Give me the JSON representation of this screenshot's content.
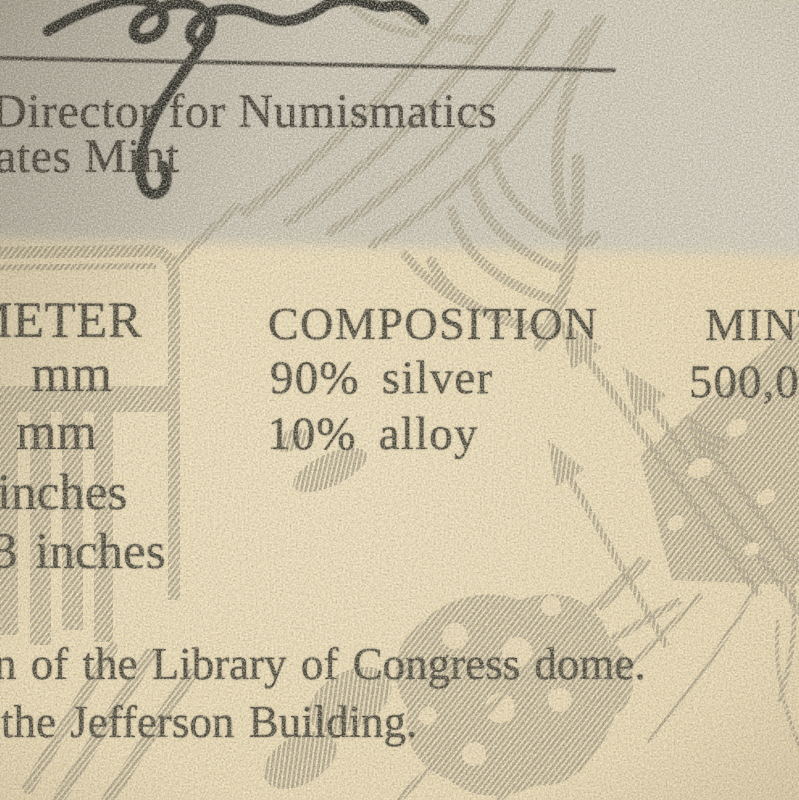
{
  "document_kind": "photograph of a printed numismatic certificate with eagle watermark",
  "header": {
    "title_line1": "Director for Numismatics",
    "title_line2": "ates Mint"
  },
  "specs": {
    "diameter": {
      "heading_fragment": "METER",
      "values": [
        "mm",
        "mm",
        "inches",
        "3 inches"
      ]
    },
    "composition": {
      "heading": "COMPOSITION",
      "values": [
        "90% silver",
        "10% alloy"
      ]
    },
    "mintage": {
      "heading_fragment": "MINT",
      "values": [
        "500,0"
      ]
    }
  },
  "footer": {
    "line1": "n of the Library of Congress dome.",
    "line2": "the Jefferson Building."
  },
  "colors": {
    "paper_shadow_band": "#c5bfb0",
    "paper_warm": "#e9d8b0",
    "watermark_gray": "#a1977f",
    "text_ink": "#3f3b2e",
    "signature_ink": "#23211c"
  }
}
